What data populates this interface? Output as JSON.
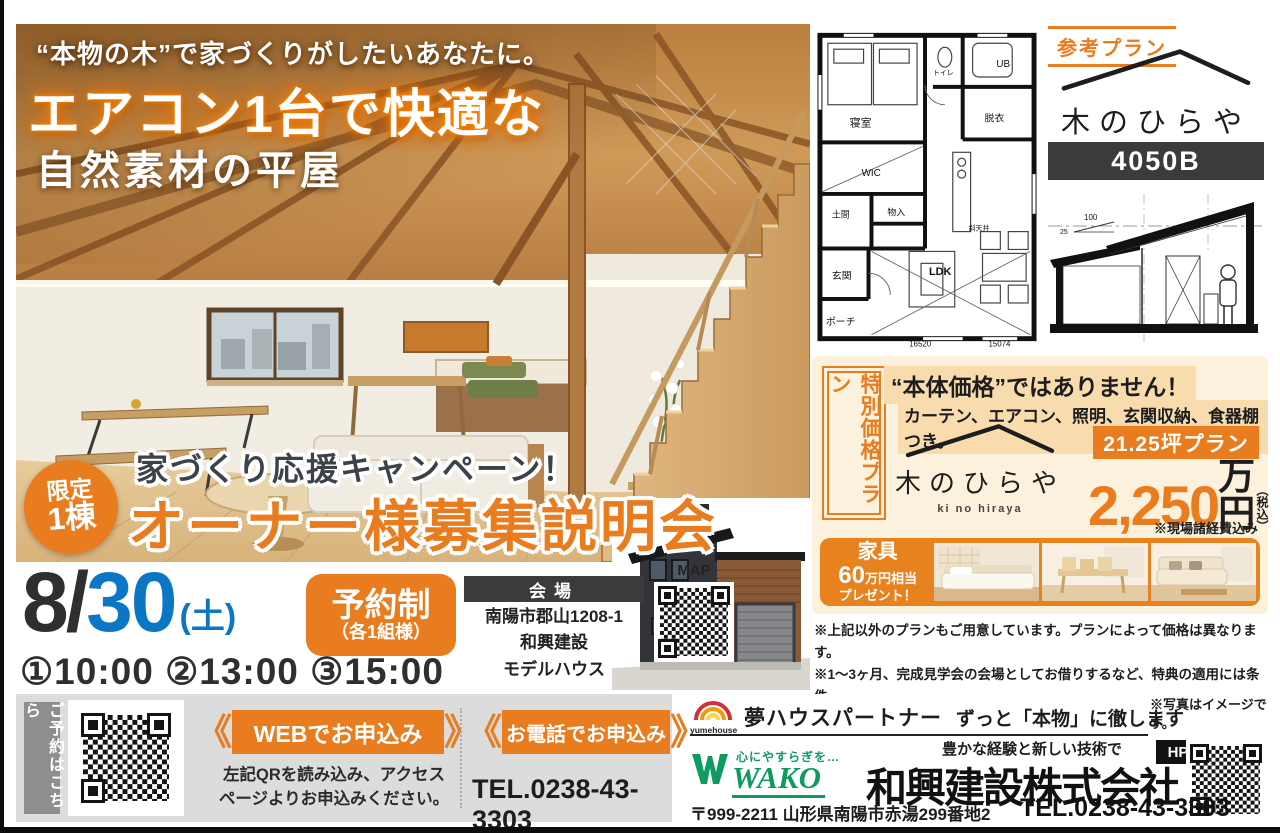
{
  "colors": {
    "orange": "#e87c1e",
    "blue": "#0b76c4",
    "dark": "#2b2b2b",
    "cream": "#fcf1dc",
    "highlight": "#f8dcae",
    "green": "#0f9b60",
    "gray_panel": "#dcdcdc"
  },
  "hero": {
    "tagline": "“本物の木”で家づくりがしたいあなたに。",
    "title": "エアコン1台で快適な",
    "subtitle": "自然素材の平屋"
  },
  "campaign": {
    "badge_top": "限定",
    "badge_bottom": "1棟",
    "lead": "家づくり応援キャンペーン！",
    "title": "オーナー様募集説明会"
  },
  "event": {
    "month": "8/",
    "day": "30",
    "weekday": "(土)",
    "reserve": "予約制",
    "reserve_sub": "（各1組様）",
    "venue_label": "会場",
    "venue_line1": "南陽市郡山1208-1",
    "venue_line2": "和興建設",
    "venue_line3": "モデルハウス",
    "map_label": "MAP",
    "times": "①10:00 ②13:00 ③15:00"
  },
  "plan": {
    "badge": "参考プラン",
    "logo_name": "木のひらや",
    "logo_roman": "ki no hiraya",
    "code": "4050B"
  },
  "floorplan": {
    "bedroom": "寝室",
    "toilet": "トイレ",
    "ub": "UB",
    "dressing": "脱衣",
    "wic": "WIC",
    "doma": "土間",
    "closet": "物入",
    "entrance": "玄関",
    "porch": "ポーチ",
    "ldk": "LDK",
    "slope_ceiling": "斜天井",
    "dim1": "16520",
    "dim2": "15074"
  },
  "section": {
    "dim1": "100",
    "dim2": "25"
  },
  "price": {
    "vertical_label": "特別価格プラン",
    "headline": "“本体価格”ではありません！",
    "subline": "カーテン、エアコン、照明、玄関収納、食器棚つき。",
    "logo_name": "木のひらや",
    "logo_roman": "ki no hiraya",
    "size_plan": "21.25坪プラン",
    "amount": "2,250",
    "unit": "万円",
    "tax": "（税込）",
    "note": "※現場諸経費込み"
  },
  "furniture": {
    "line1": "家具",
    "amount": "60",
    "amount_suffix": "万円相当",
    "line3": "プレゼント！"
  },
  "notes": {
    "line1": "※上記以外のプランもご用意しています。プランによって価格は異なります。",
    "line2": "※1〜3ヶ月、完成見学会の会場としてお借りするなど、特典の適用には条件",
    "line3": "がございます。※その他詳細な条件は、説明会でご説明いたします。"
  },
  "booking": {
    "vertical_label": "ご予約はこちら",
    "web_ribbon": "WEBでお申込み",
    "web_desc1": "左記QRを読み込み、アクセス",
    "web_desc2": "ページよりお申込みください。",
    "tel_ribbon": "お電話でお申込み",
    "tel_number": "TEL.0238-43-3303"
  },
  "company": {
    "partner_logo": "yumehouse",
    "partner": "夢ハウスパートナー",
    "slogan": "ずっと「本物」に徹します",
    "photo_note": "※写真はイメージです。",
    "hp": "HP",
    "wako_catch": "心にやすらぎを…",
    "wako": "WAKO",
    "tagline": "豊かな経験と新しい技術で",
    "name": "和興建設株式会社",
    "address": "〒999-2211 山形県南陽市赤湯299番地2",
    "tel": "TEL.0238-43-3303"
  }
}
